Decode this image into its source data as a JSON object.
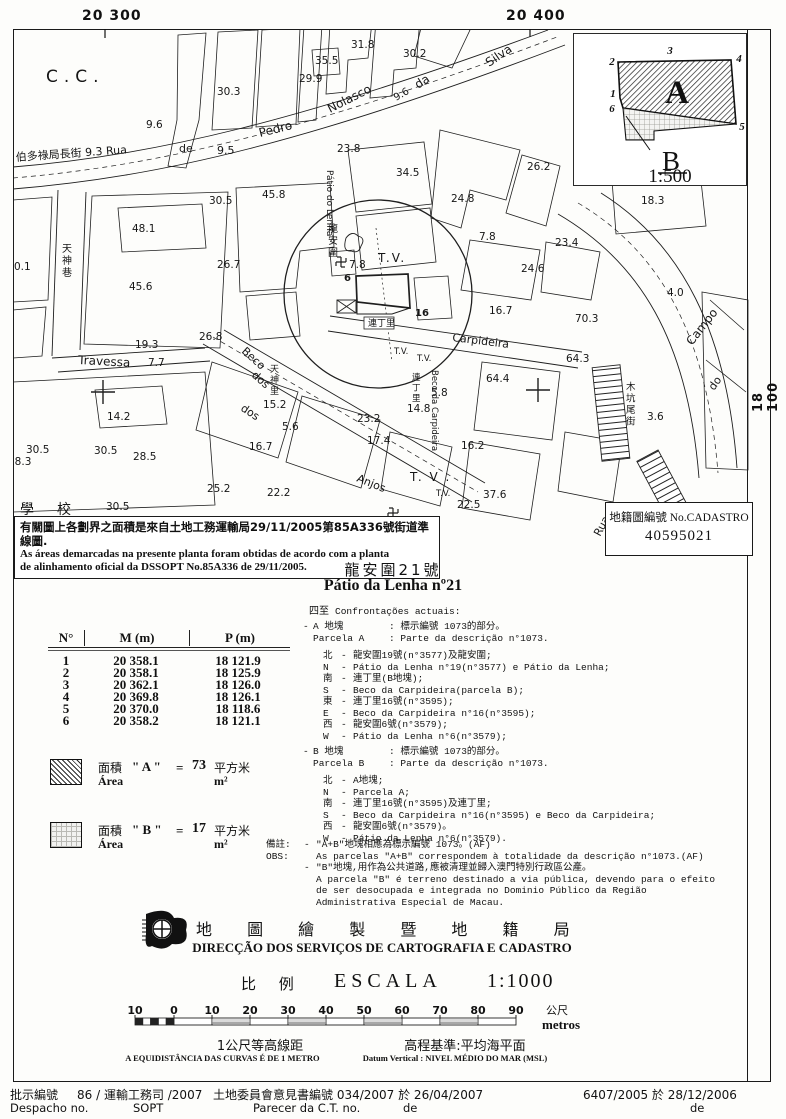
{
  "coords": {
    "top_left": "20 300",
    "top_right": "20 400",
    "right": "18 100"
  },
  "inset": {
    "corners": [
      "1",
      "2",
      "3",
      "4",
      "5",
      "6"
    ],
    "label_a": "A",
    "label_b": "B",
    "scale": "1:500"
  },
  "cadastro": {
    "label": "地籍圖編號 No.CADASTRO",
    "number": "40595021"
  },
  "notebox": {
    "line1_zh": "有關圖上各劃界之面積是來自土地工務運輸局29/11/2005第85A336號街道準線圖.",
    "line2_pt": "As áreas demarcadas na presente planta foram obtidas de acordo com a planta",
    "line3_pt": "de alinhamento oficial da DSSOPT  No.85A336 de 29/11/2005."
  },
  "title": {
    "zh": "龍安圍21號",
    "pt": "Pátio da Lenha nº21"
  },
  "table": {
    "headers": [
      "N°",
      "M (m)",
      "P (m)"
    ],
    "rows": [
      [
        "1",
        "20 358.1",
        "18 121.9"
      ],
      [
        "2",
        "20 358.1",
        "18 125.9"
      ],
      [
        "3",
        "20 362.1",
        "18 126.0"
      ],
      [
        "4",
        "20 369.8",
        "18 126.1"
      ],
      [
        "5",
        "20 370.0",
        "18 118.6"
      ],
      [
        "6",
        "20 358.2",
        "18 121.1"
      ]
    ]
  },
  "areas": [
    {
      "zh": "面積",
      "pt": "Área",
      "name": "\" A \"",
      "eq": "=",
      "value": "73",
      "unit_zh": "平方米",
      "unit_pt": "m²"
    },
    {
      "zh": "面積",
      "pt": "Área",
      "name": "\" B \"",
      "eq": "=",
      "value": "17",
      "unit_zh": "平方米",
      "unit_pt": "m²"
    }
  ],
  "confrontacoes": {
    "heading_zh": "四至",
    "heading_pt": "Confrontações actuais:",
    "parcels": [
      {
        "top": 621,
        "bullet": "-",
        "id_zh": "A 地塊",
        "desc_zh": ": 標示編號 1073的部分。",
        "id_pt": "Parcela A",
        "desc_pt": ": Parte da descrição n°1073.",
        "sides": [
          [
            "北",
            "-",
            "龍安圍19號(n°3577)及龍安圍;"
          ],
          [
            "N",
            "-",
            "Pátio da Lenha n°19(n°3577) e Pátio da Lenha;"
          ],
          [
            "南",
            "-",
            "連丁里(B地塊);"
          ],
          [
            "S",
            "-",
            "Beco da Carpideira(parcela B);"
          ],
          [
            "東",
            "-",
            "連丁里16號(n°3595);"
          ],
          [
            "E",
            "-",
            "Beco da Carpideira n°16(n°3595);"
          ],
          [
            "西",
            "-",
            "龍安圍6號(n°3579);"
          ],
          [
            "W",
            "-",
            "Pátio da Lenha n°6(n°3579);"
          ]
        ]
      },
      {
        "top": 746,
        "bullet": "-",
        "id_zh": "B 地塊",
        "desc_zh": ": 標示編號 1073的部分。",
        "id_pt": "Parcela B",
        "desc_pt": ": Parte da descrição n°1073.",
        "sides": [
          [
            "北",
            "-",
            "A地塊;"
          ],
          [
            "N",
            "-",
            "Parcela A;"
          ],
          [
            "南",
            "-",
            "連丁里16號(n°3595)及連丁里;"
          ],
          [
            "S",
            "-",
            "Beco da Carpideira n°16(n°3595) e Beco da Carpideira;"
          ],
          [
            "西",
            "-",
            "龍安圍6號(n°3579)。"
          ],
          [
            "W",
            "-",
            "Pátio da Lenha n°6(n°3579)."
          ]
        ]
      }
    ]
  },
  "remarks": {
    "rows": [
      {
        "label": "備註:",
        "bullet": "-",
        "text": "\"A+B\"地塊相應為標示編號 1073。(AF)"
      },
      {
        "label": "OBS:",
        "bullet": "",
        "text": "As parcelas \"A+B\" correspondem à totalidade da descrição n°1073.(AF)"
      },
      {
        "label": "",
        "bullet": "-",
        "text": "\"B\"地塊,用作為公共道路,應被清理並歸入澳門特別行政區公產。"
      },
      {
        "label": "",
        "bullet": "",
        "text": "A parcela \"B\" é terreno destinado a via pública, devendo para o efeito"
      },
      {
        "label": "",
        "bullet": "",
        "text": "de ser desocupada e integrada no Dominio Público da Região"
      },
      {
        "label": "",
        "bullet": "",
        "text": "Administrativa Especial de Macau."
      }
    ]
  },
  "agency": {
    "zh": "地 圖 繪 製 暨 地 籍 局",
    "pt": "DIRECÇÃO DOS SERVIÇOS DE CARTOGRAFIA E CADASTRO"
  },
  "scale": {
    "zh": "比 例",
    "pt": "ESCALA",
    "ratio": "1:1000",
    "bar_labels": [
      "10",
      "0",
      "10",
      "20",
      "30",
      "40",
      "50",
      "60",
      "70",
      "80",
      "90"
    ],
    "unit_zh": "公尺",
    "unit_pt": "metros",
    "contour_zh": "1公尺等高線距",
    "contour_pt": "A EQUIDISTÂNCIA DAS CURVAS É DE 1 METRO",
    "datum_zh": "高程基準:平均海平面",
    "datum_pt": "Datum Vertical : NIVEL MÉDIO DO MAR (MSL)"
  },
  "footer": {
    "despacho_zh": "批示編號",
    "despacho_no": "86 / 運輸工務司 /2007",
    "despacho_pt": "Despacho no.",
    "despacho_dept": "SOPT",
    "parecer_zh": "土地委員會意見書編號 034/2007 於 26/04/2007",
    "parecer_pt": "Parecer da C.T. no.",
    "parecer_de": "de",
    "ref2": "6407/2005 於 28/12/2006",
    "ref2_de": "de"
  },
  "map": {
    "labels": [
      {
        "t": "C.C.",
        "x": 46,
        "y": 82,
        "s": 17,
        "sp": 6
      },
      {
        "t": "30.3",
        "x": 217,
        "y": 95
      },
      {
        "t": "29.9",
        "x": 299,
        "y": 82
      },
      {
        "t": "35.5",
        "x": 315,
        "y": 64
      },
      {
        "t": "31.8",
        "x": 351,
        "y": 48
      },
      {
        "t": "30.2",
        "x": 403,
        "y": 57
      },
      {
        "t": "9.6",
        "x": 146,
        "y": 128
      },
      {
        "t": "伯多祿局長街 9.3 Rua",
        "x": 16,
        "y": 161,
        "s": 11,
        "r": -4
      },
      {
        "t": "de",
        "x": 179,
        "y": 152,
        "s": 11
      },
      {
        "t": "9.5",
        "x": 217,
        "y": 154,
        "s": 11
      },
      {
        "t": "Pedro",
        "x": 260,
        "y": 137,
        "s": 12,
        "r": -14
      },
      {
        "t": "Nolasco",
        "x": 330,
        "y": 113,
        "s": 12,
        "r": -27
      },
      {
        "t": "9.6",
        "x": 396,
        "y": 101,
        "s": 10,
        "r": -30
      },
      {
        "t": "da",
        "x": 418,
        "y": 89,
        "s": 12,
        "r": -33
      },
      {
        "t": "Silva",
        "x": 489,
        "y": 67,
        "s": 12,
        "r": -34
      },
      {
        "t": "23.8",
        "x": 337,
        "y": 152
      },
      {
        "t": "45.8",
        "x": 262,
        "y": 198
      },
      {
        "t": "30.5",
        "x": 209,
        "y": 204
      },
      {
        "t": "48.1",
        "x": 132,
        "y": 232
      },
      {
        "t": "26.7",
        "x": 217,
        "y": 268
      },
      {
        "t": "45.6",
        "x": 129,
        "y": 290
      },
      {
        "t": "19.3",
        "x": 135,
        "y": 348
      },
      {
        "t": "0.1",
        "x": 14,
        "y": 270
      },
      {
        "t": "Travessa",
        "x": 78,
        "y": 364,
        "s": 12,
        "r": 3
      },
      {
        "t": "7.7",
        "x": 148,
        "y": 366
      },
      {
        "t": "34.5",
        "x": 396,
        "y": 176
      },
      {
        "t": "24.8",
        "x": 451,
        "y": 202
      },
      {
        "t": "26.2",
        "x": 527,
        "y": 170
      },
      {
        "t": "18.3",
        "x": 641,
        "y": 204
      },
      {
        "t": "23.4",
        "x": 555,
        "y": 246
      },
      {
        "t": "24.6",
        "x": 521,
        "y": 272
      },
      {
        "t": "7.8",
        "x": 479,
        "y": 240
      },
      {
        "t": "4.0",
        "x": 667,
        "y": 296
      },
      {
        "t": "70.3",
        "x": 575,
        "y": 322
      },
      {
        "t": "64.3",
        "x": 566,
        "y": 362
      },
      {
        "t": "64.4",
        "x": 486,
        "y": 382
      },
      {
        "t": "16.7",
        "x": 489,
        "y": 314
      },
      {
        "t": "16.7",
        "x": 249,
        "y": 450
      },
      {
        "t": "25.2",
        "x": 207,
        "y": 492
      },
      {
        "t": "22.2",
        "x": 267,
        "y": 496
      },
      {
        "t": "15.2",
        "x": 263,
        "y": 408
      },
      {
        "t": "5.6",
        "x": 282,
        "y": 430
      },
      {
        "t": "23.2",
        "x": 357,
        "y": 422
      },
      {
        "t": "14.8",
        "x": 407,
        "y": 412
      },
      {
        "t": "17.4",
        "x": 367,
        "y": 444
      },
      {
        "t": "16.2",
        "x": 461,
        "y": 449
      },
      {
        "t": "5.8",
        "x": 431,
        "y": 396
      },
      {
        "t": "22.5",
        "x": 457,
        "y": 508
      },
      {
        "t": "37.6",
        "x": 483,
        "y": 498
      },
      {
        "t": "18.6",
        "x": 409,
        "y": 541
      },
      {
        "t": "3.6",
        "x": 647,
        "y": 420
      },
      {
        "t": "30.5",
        "x": 94,
        "y": 454
      },
      {
        "t": "14.2",
        "x": 107,
        "y": 420
      },
      {
        "t": "28.5",
        "x": 133,
        "y": 460
      },
      {
        "t": "30.5",
        "x": 106,
        "y": 510
      },
      {
        "t": "18.3",
        "x": 8,
        "y": 465
      },
      {
        "t": "30.5",
        "x": 26,
        "y": 453
      },
      {
        "t": "26.8",
        "x": 199,
        "y": 340
      },
      {
        "t": "7.8",
        "x": 349,
        "y": 268
      },
      {
        "t": "6",
        "x": 344,
        "y": 281,
        "s": 10,
        "b": 1
      },
      {
        "t": "16",
        "x": 415,
        "y": 316,
        "s": 10,
        "b": 1
      },
      {
        "t": "T.V.",
        "x": 378,
        "y": 262,
        "s": 12,
        "sp": 2
      },
      {
        "t": "T. V .",
        "x": 410,
        "y": 481,
        "s": 12,
        "sp": 2
      },
      {
        "t": "T.V.",
        "x": 394,
        "y": 354,
        "s": 8.5
      },
      {
        "t": "T.V.",
        "x": 417,
        "y": 361,
        "s": 8.5
      },
      {
        "t": "T.V.",
        "x": 436,
        "y": 496,
        "s": 8.5
      },
      {
        "t": "Beco",
        "x": 241,
        "y": 352,
        "s": 11,
        "r": 42
      },
      {
        "t": "dos",
        "x": 251,
        "y": 376,
        "s": 11,
        "r": 42
      },
      {
        "t": "dos",
        "x": 240,
        "y": 410,
        "s": 11,
        "r": 33
      },
      {
        "t": "Anjos",
        "x": 356,
        "y": 481,
        "s": 11,
        "r": 22
      },
      {
        "t": "Carpideira",
        "x": 452,
        "y": 341,
        "s": 11,
        "r": 7
      },
      {
        "t": "Campo",
        "x": 692,
        "y": 346,
        "s": 12,
        "r": -52
      },
      {
        "t": "Rua",
        "x": 600,
        "y": 537,
        "s": 11,
        "r": -62
      },
      {
        "t": "do",
        "x": 714,
        "y": 391,
        "s": 11,
        "r": -55
      },
      {
        "t": "Pátio do Lenha",
        "x": 327,
        "y": 170,
        "s": 9,
        "r": 90
      },
      {
        "t": "Beco da Carpideira",
        "x": 432,
        "y": 370,
        "s": 8.5,
        "r": 90
      },
      {
        "t": "龍安圍",
        "x": 328,
        "y": 232,
        "s": 10,
        "v": 1
      },
      {
        "t": "天神巷",
        "x": 62,
        "y": 252,
        "s": 10,
        "v": 1
      },
      {
        "t": "天神里",
        "x": 270,
        "y": 372,
        "s": 9,
        "v": 1
      },
      {
        "t": "木坑尾街",
        "x": 626,
        "y": 390,
        "s": 9.5,
        "v": 1
      },
      {
        "t": "連丁里",
        "x": 412,
        "y": 380,
        "s": 8.5,
        "v": 1
      },
      {
        "t": "連丁里",
        "x": 368,
        "y": 326,
        "s": 9
      },
      {
        "t": "學",
        "x": 20,
        "y": 514,
        "s": 14
      },
      {
        "t": "校",
        "x": 57,
        "y": 514,
        "s": 14
      }
    ],
    "swastikas": [
      [
        341,
        262
      ],
      [
        393,
        513
      ]
    ],
    "crosses": [
      [
        103,
        392
      ],
      [
        538,
        390
      ]
    ]
  }
}
